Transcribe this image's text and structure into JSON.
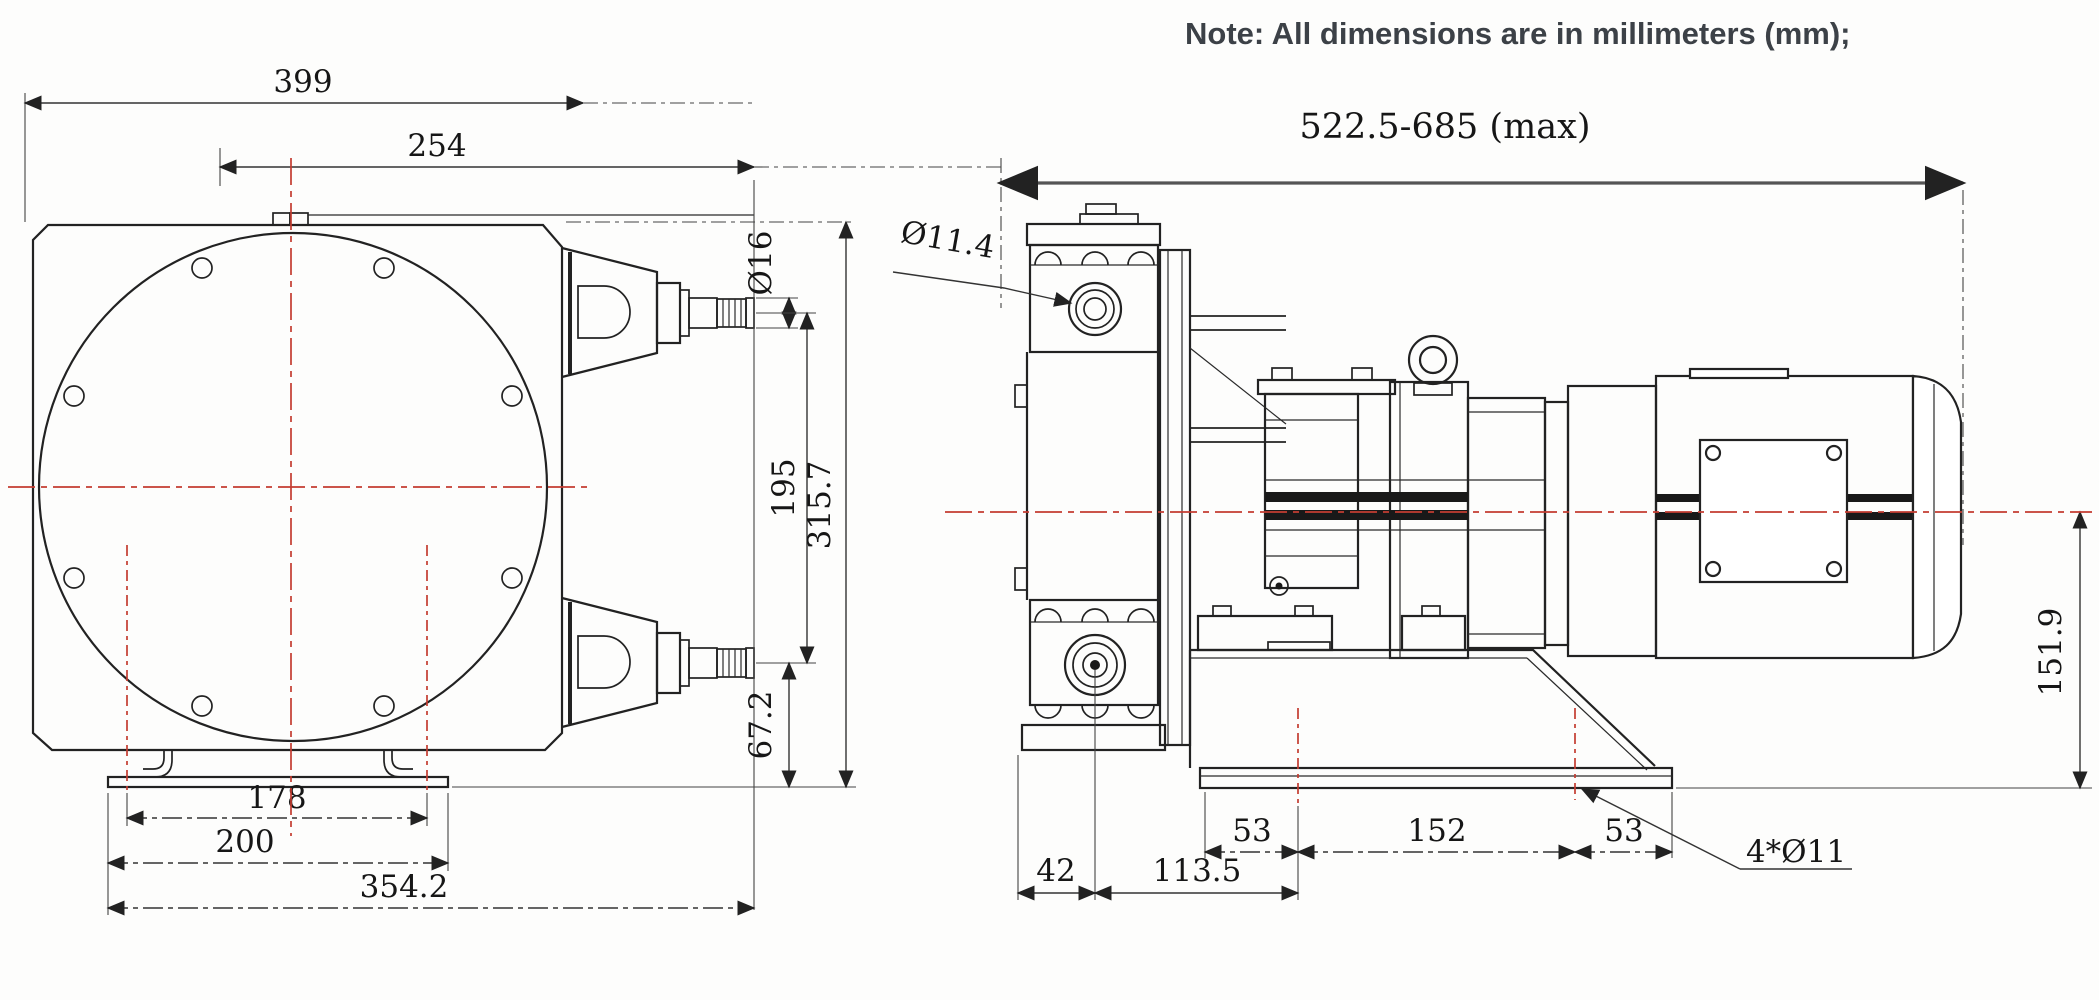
{
  "note": "Note: All dimensions are in millimeters (mm);",
  "colors": {
    "line": "#222222",
    "centerline": "#c43c31",
    "dim_line": "#555555"
  },
  "front_view": {
    "dims": {
      "overall_width": "399",
      "port_offset_width": "254",
      "nozzle_diameter": "Ø16",
      "nozzle_vertical_spacing": "195",
      "overall_height": "315.7",
      "nozzle_to_base": "67.2",
      "foot_slot_spacing": "178",
      "foot_plate_width": "200",
      "base_overall_width": "354.2"
    }
  },
  "side_view": {
    "dims": {
      "overall_length": "522.5-685 (max)",
      "port_bore_diameter": "Ø11.4",
      "port_center_offset": "42",
      "port_to_bolt_hole": "113.5",
      "bolt_edge_left": "53",
      "bolt_hole_pitch": "152",
      "bolt_edge_right": "53",
      "mounting_holes": "4*Ø11",
      "shaft_center_height": "151.9"
    }
  }
}
